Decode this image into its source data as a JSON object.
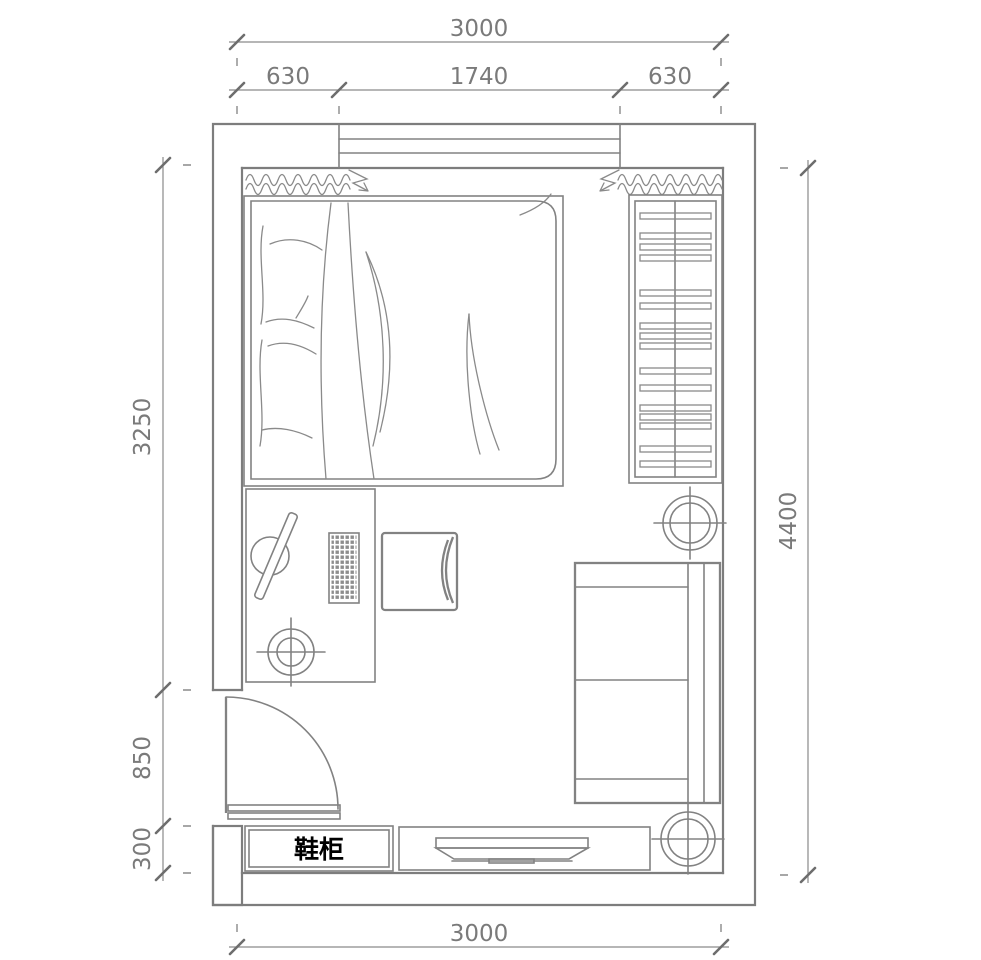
{
  "labels": {
    "shoe_cabinet": "鞋柜"
  },
  "dimensions": {
    "top": {
      "total": "3000",
      "segments": [
        "630",
        "1740",
        "630"
      ]
    },
    "left": {
      "segments": [
        "3250",
        "850",
        "300"
      ]
    },
    "right": {
      "total": "4400"
    },
    "bottom": {
      "total": "3000"
    }
  },
  "colors": {
    "line": "#7d7d7d",
    "furniture_line": "#828282",
    "dim_text": "#7a7a7a",
    "label_text": "#000000",
    "background": "#ffffff"
  }
}
